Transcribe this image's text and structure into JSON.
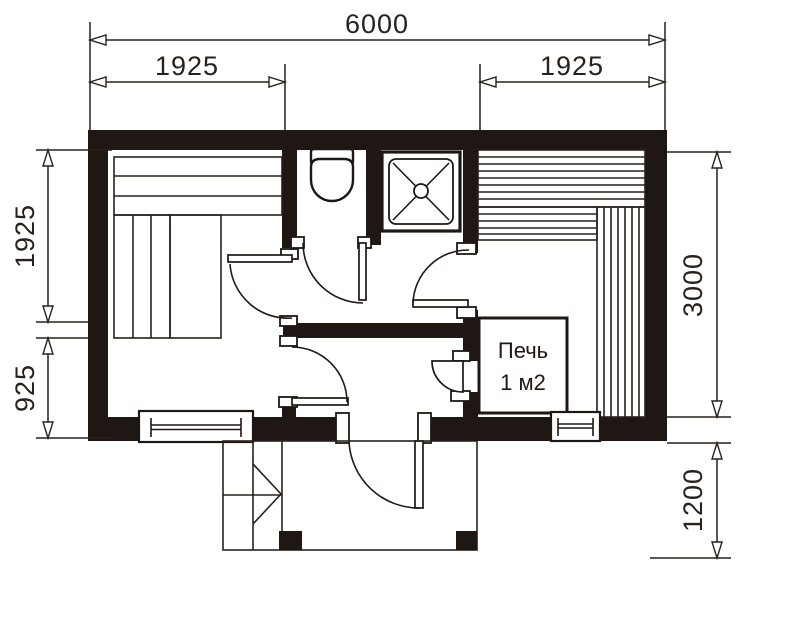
{
  "plan": {
    "dimensions": {
      "top_total": "6000",
      "top_left_bay": "1925",
      "top_right_bay": "1925",
      "left_upper": "1925",
      "left_lower": "925",
      "right_height": "3000",
      "right_porch_depth": "1200"
    },
    "stove_label": {
      "line1": "Печь",
      "line2": "1 м2"
    },
    "colors": {
      "wall": "#1e1714",
      "line": "#29211c",
      "background": "#ffffff"
    }
  }
}
